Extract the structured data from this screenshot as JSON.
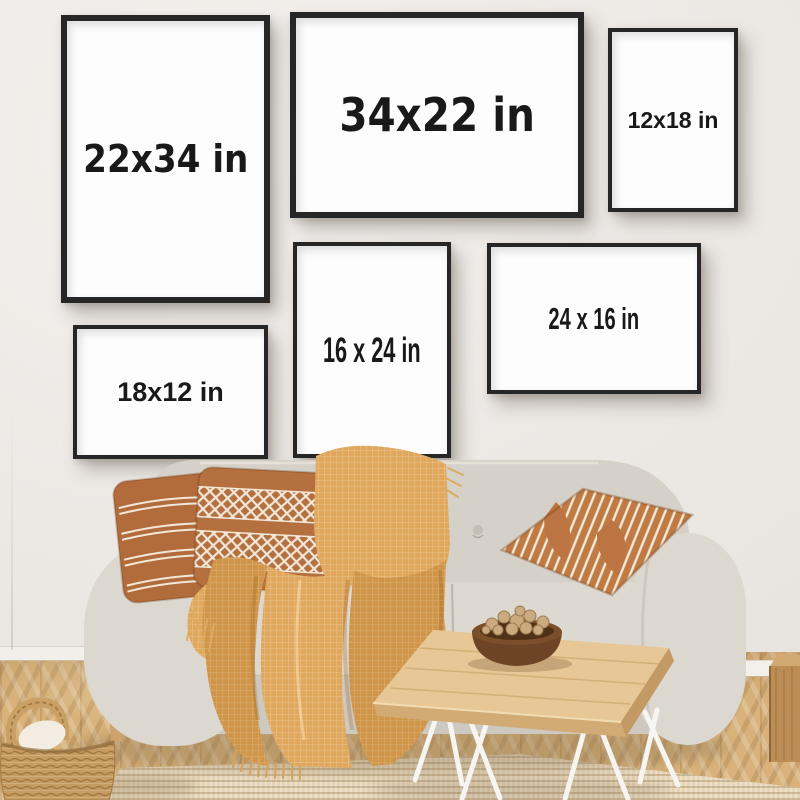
{
  "frames": [
    {
      "label": "22x34 in",
      "orientation": "portrait"
    },
    {
      "label": "34x22 in",
      "orientation": "landscape"
    },
    {
      "label": "12x18 in",
      "orientation": "portrait"
    },
    {
      "label": "16 x 24 in",
      "orientation": "portrait"
    },
    {
      "label": "24 x 16 in",
      "orientation": "landscape"
    },
    {
      "label": "18x12 in",
      "orientation": "landscape"
    }
  ],
  "colors": {
    "wall": "#ece8e4",
    "frame_border": "#262626",
    "frame_matte": "#fdfdfd",
    "label_text": "#191919",
    "floor_wood": "#d8b27a",
    "rug": "#e6d5b6",
    "sofa_fabric": "#d8d4cc",
    "pillow_caramel": "#b5703f",
    "blanket_mustard": "#dfa75d",
    "table_wood": "#e7c795",
    "basket_wicker": "#c79c63"
  }
}
